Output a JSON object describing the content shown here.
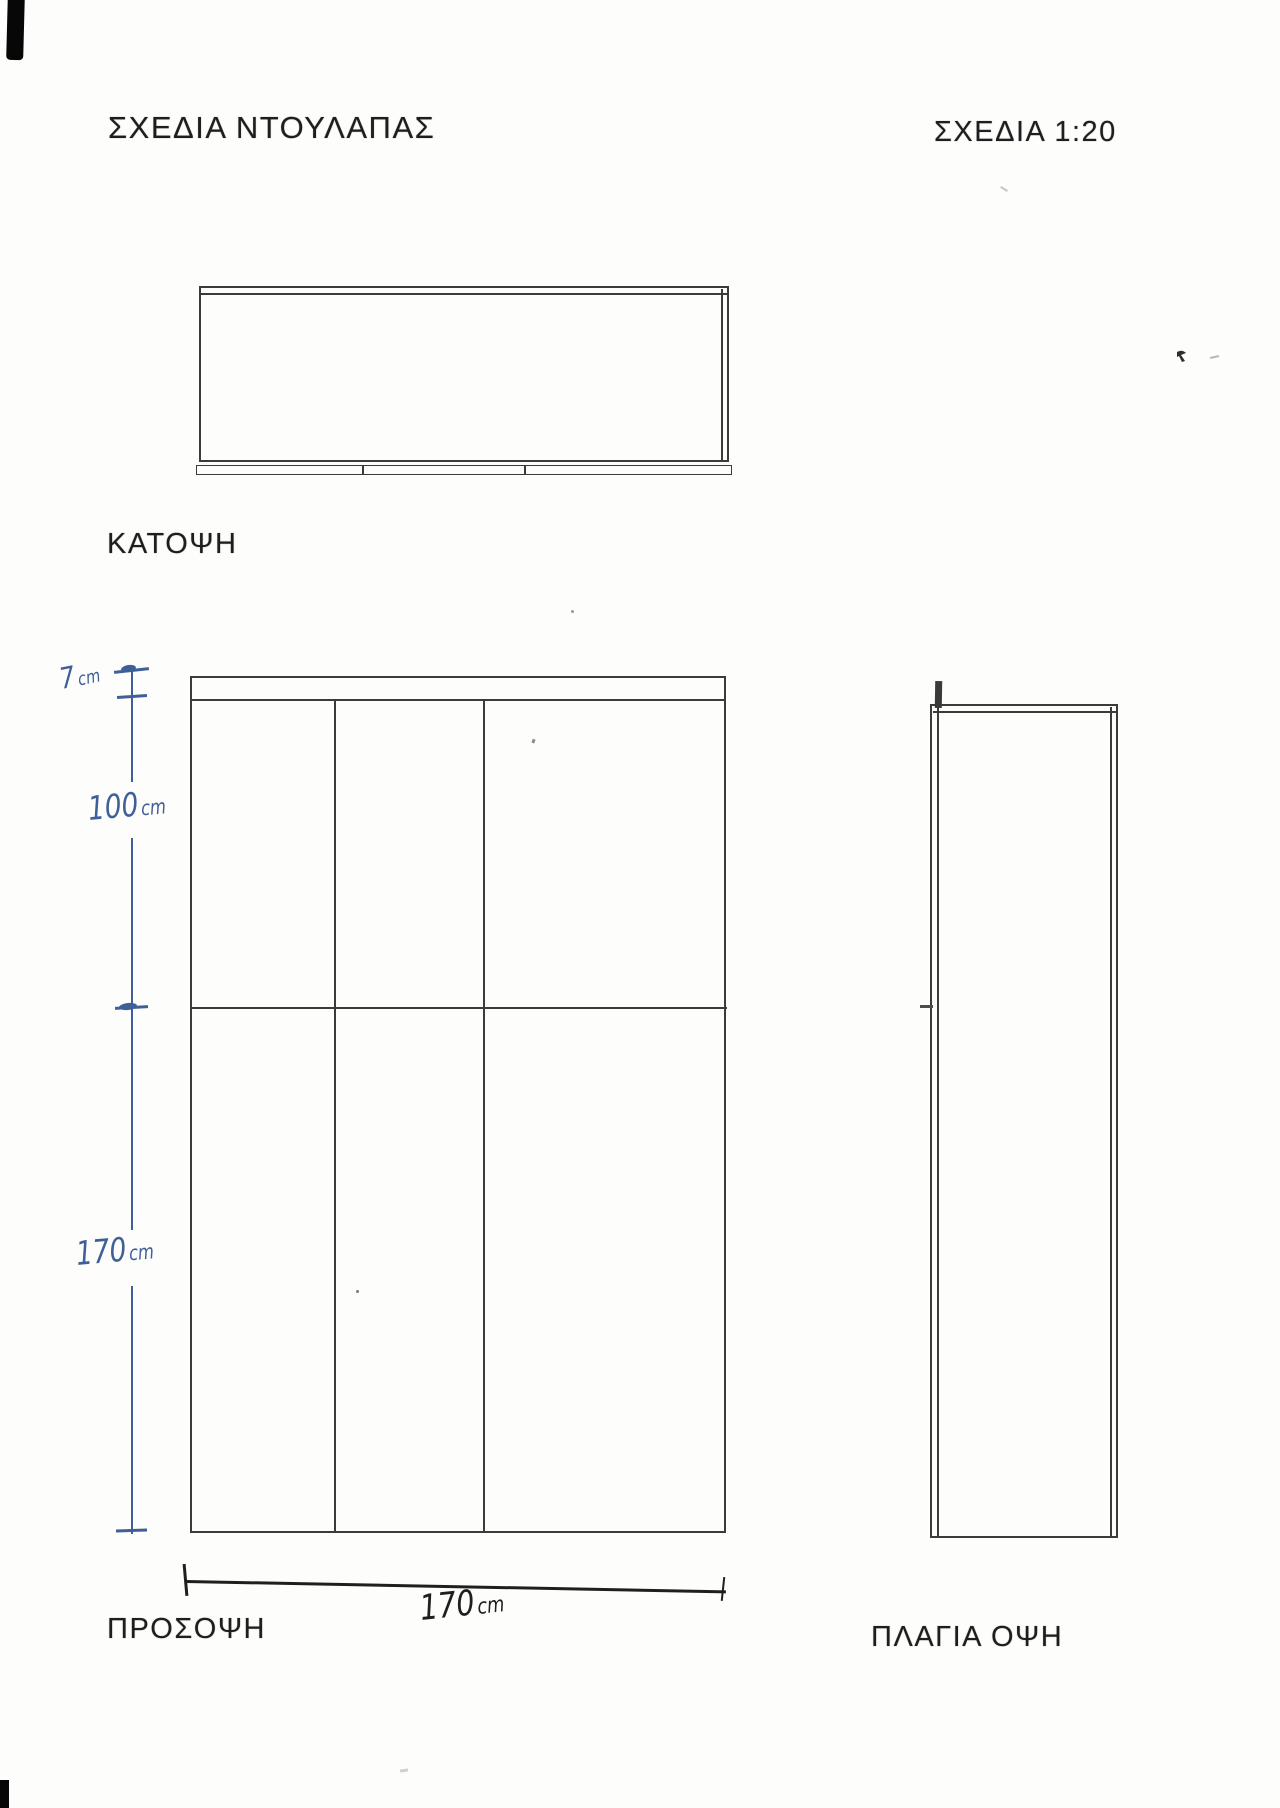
{
  "header": {
    "title": "ΣΧΕΔΙΑ ΝΤΟΥΛΑΠΑΣ",
    "scale": "ΣΧΕΔΙΑ 1:20"
  },
  "views": {
    "plan": {
      "label": "ΚΑΤΟΨΗ"
    },
    "front": {
      "label": "ΠΡΟΣΟΨΗ"
    },
    "side": {
      "label": "ΠΛΑΓΙΑ ΟΨΗ"
    }
  },
  "dimensions": {
    "top_thickness": {
      "num": "7",
      "unit": "cm"
    },
    "upper_section_height": {
      "num": "100",
      "unit": "cm"
    },
    "lower_section_height": {
      "num": "170",
      "unit": "cm"
    },
    "overall_width": {
      "num": "170",
      "unit": "cm"
    }
  },
  "colors": {
    "pencil": "#3b3b3b",
    "blue_ink": "#3f5f98",
    "dark_ink": "#1f1f1f",
    "paper": "#fdfdfc"
  }
}
